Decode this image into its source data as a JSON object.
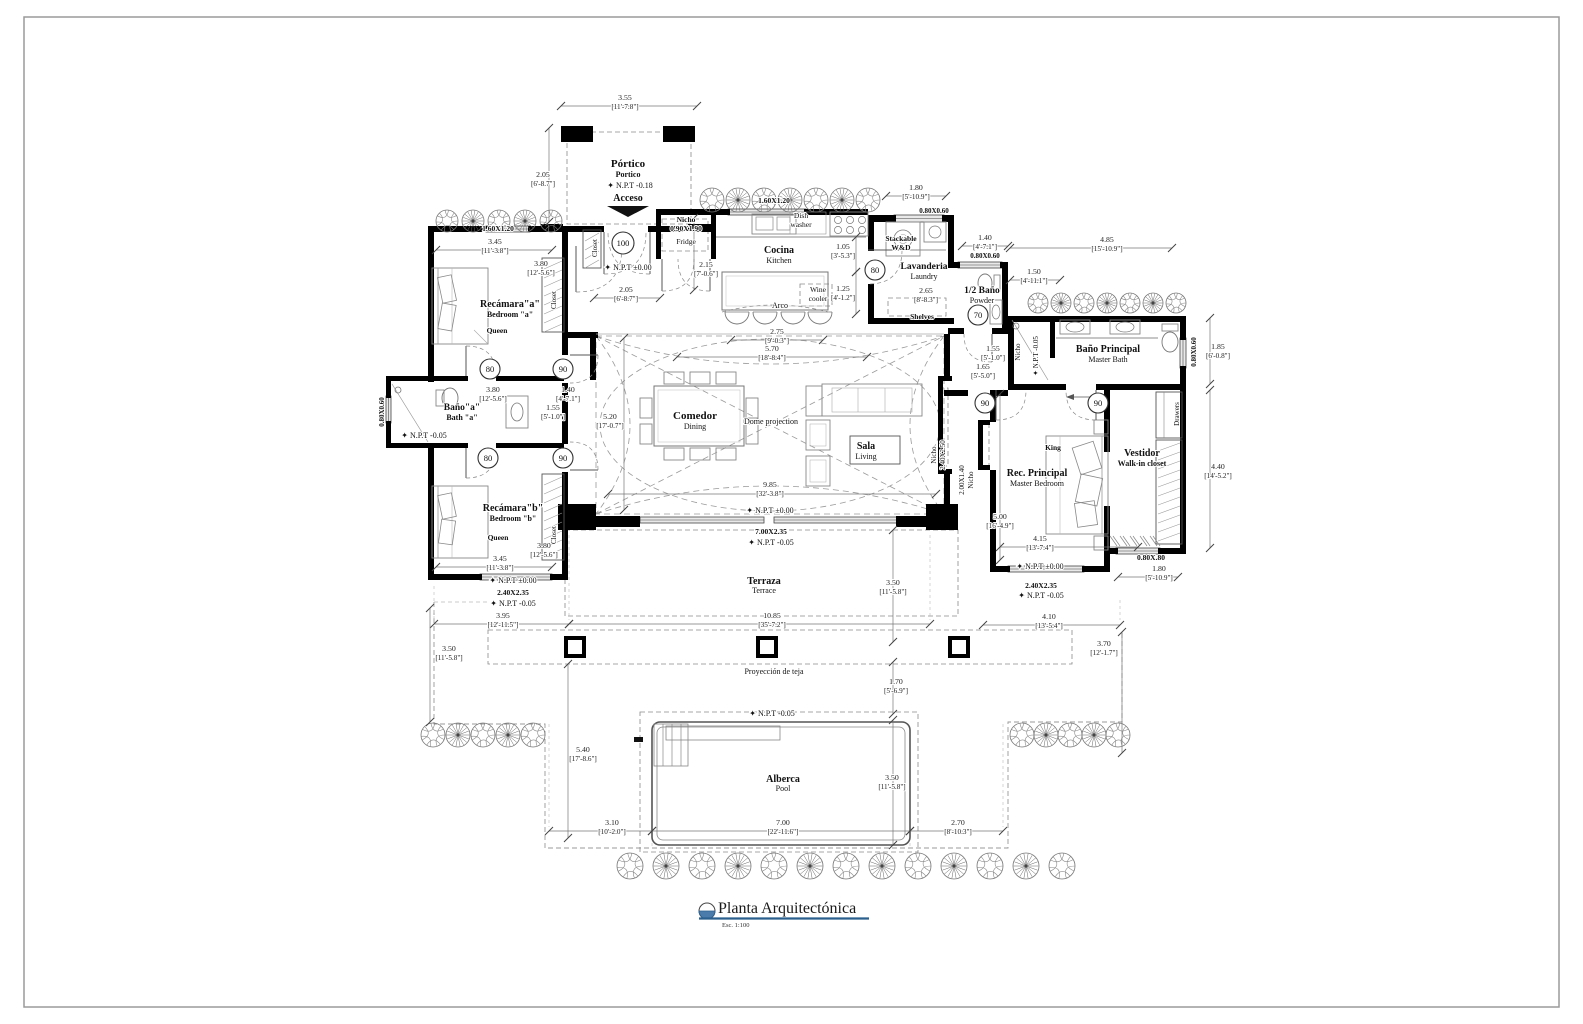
{
  "title_block": {
    "title": "Planta Arquitectónica",
    "scale": "Esc. 1:100"
  },
  "door_tags": [
    {
      "t": "100",
      "x": 623,
      "y": 243,
      "r": 11
    },
    {
      "t": "80",
      "x": 875,
      "y": 270,
      "r": 10
    },
    {
      "t": "70",
      "x": 978,
      "y": 315,
      "r": 10
    },
    {
      "t": "80",
      "x": 490,
      "y": 369,
      "r": 10
    },
    {
      "t": "90",
      "x": 563,
      "y": 369,
      "r": 10
    },
    {
      "t": "80",
      "x": 488,
      "y": 458,
      "r": 10
    },
    {
      "t": "90",
      "x": 563,
      "y": 458,
      "r": 10
    },
    {
      "t": "90",
      "x": 985,
      "y": 403,
      "r": 10
    },
    {
      "t": "90",
      "x": 1098,
      "y": 403,
      "r": 10
    }
  ],
  "labels": [
    {
      "t": "Pórtico",
      "x": 628,
      "y": 167,
      "s": 11,
      "b": 1,
      "n": "room-portico"
    },
    {
      "t": "Portico",
      "x": 628,
      "y": 177,
      "s": 8,
      "b": 1,
      "n": "room-portico-en"
    },
    {
      "t": "✦ N.P.T -0.18",
      "x": 630,
      "y": 188,
      "s": 8,
      "n": "npt-portico"
    },
    {
      "t": "Acceso",
      "x": 628,
      "y": 201,
      "s": 10,
      "b": 1,
      "n": "access-label"
    },
    {
      "t": "Closet",
      "x": 597,
      "y": 248,
      "s": 7,
      "r": -90,
      "n": "closet-foyer"
    },
    {
      "t": "✦ N.P.T ±0.00",
      "x": 628,
      "y": 270,
      "s": 8,
      "n": "npt-foyer"
    },
    {
      "t": "Nicho",
      "x": 686,
      "y": 222,
      "s": 7.5,
      "b": 1,
      "n": "fridge-nicho"
    },
    {
      "t": "0.90X1.90",
      "x": 686,
      "y": 231,
      "s": 7.5,
      "b": 1,
      "n": "fridge-nicho-size"
    },
    {
      "t": "Fridge",
      "x": 686,
      "y": 244,
      "s": 7.5,
      "n": "fridge"
    },
    {
      "t": "1.60X1.20",
      "x": 774,
      "y": 203,
      "s": 7.5,
      "b": 1,
      "n": "kitchen-window-size"
    },
    {
      "t": "Dish",
      "x": 801,
      "y": 218,
      "s": 7.5,
      "n": "dishwasher-1"
    },
    {
      "t": "washer",
      "x": 801,
      "y": 227,
      "s": 7.5,
      "n": "dishwasher-2"
    },
    {
      "t": "Cocina",
      "x": 779,
      "y": 253,
      "s": 10,
      "b": 1,
      "n": "room-kitchen"
    },
    {
      "t": "Kitchen",
      "x": 779,
      "y": 263,
      "s": 8,
      "n": "room-kitchen-en"
    },
    {
      "t": "Wine",
      "x": 818,
      "y": 292,
      "s": 7.5,
      "n": "wine-cooler-1"
    },
    {
      "t": "cooler",
      "x": 818,
      "y": 301,
      "s": 7.5,
      "n": "wine-cooler-2"
    },
    {
      "t": "Arco",
      "x": 780,
      "y": 308,
      "s": 8,
      "n": "arch-label"
    },
    {
      "t": "0.80X0.60",
      "x": 934,
      "y": 213,
      "s": 7,
      "b": 1,
      "n": "laundry-window-size"
    },
    {
      "t": "Stackable",
      "x": 901,
      "y": 241,
      "s": 7.5,
      "b": 1,
      "n": "washer-dryer-1"
    },
    {
      "t": "W&D",
      "x": 901,
      "y": 250,
      "s": 7.5,
      "b": 1,
      "n": "washer-dryer-2"
    },
    {
      "t": "Lavanderia",
      "x": 924,
      "y": 269,
      "s": 9.5,
      "b": 1,
      "n": "room-laundry"
    },
    {
      "t": "Laundry",
      "x": 924,
      "y": 279,
      "s": 8,
      "n": "room-laundry-en"
    },
    {
      "t": "Shelves",
      "x": 922,
      "y": 319,
      "s": 7.5,
      "b": 1,
      "n": "shelves"
    },
    {
      "t": "0.80X0.60",
      "x": 985,
      "y": 258,
      "s": 7,
      "b": 1,
      "n": "powder-window-size"
    },
    {
      "t": "1/2 Baño",
      "x": 982,
      "y": 293,
      "s": 9.5,
      "b": 1,
      "n": "room-powder"
    },
    {
      "t": "Powder",
      "x": 982,
      "y": 303,
      "s": 8,
      "n": "room-powder-en"
    },
    {
      "t": "Baño Principal",
      "x": 1108,
      "y": 352,
      "s": 10,
      "b": 1,
      "n": "room-master-bath"
    },
    {
      "t": "Master Bath",
      "x": 1108,
      "y": 362,
      "s": 8,
      "n": "room-master-bath-en"
    },
    {
      "t": "Nicho",
      "x": 1020,
      "y": 352,
      "s": 7,
      "r": -90,
      "n": "shower-nicho"
    },
    {
      "t": "✦ N.P.T -0.05",
      "x": 1038,
      "y": 356,
      "s": 7,
      "r": -90,
      "n": "npt-shower"
    },
    {
      "t": "0.80X0.60",
      "x": 1196,
      "y": 352,
      "s": 7,
      "b": 1,
      "r": -90,
      "n": "masterbath-window-size"
    },
    {
      "t": "1.60X1.20",
      "x": 498,
      "y": 231,
      "s": 7.5,
      "b": 1,
      "n": "bedroom-a-window-size"
    },
    {
      "t": "Recámara\"a\"",
      "x": 510,
      "y": 307,
      "s": 10,
      "b": 1,
      "n": "room-bedroom-a"
    },
    {
      "t": "Bedroom \"a\"",
      "x": 510,
      "y": 317,
      "s": 8,
      "b": 1,
      "n": "room-bedroom-a-en"
    },
    {
      "t": "Queen",
      "x": 497,
      "y": 333,
      "s": 7.5,
      "b": 1,
      "n": "bed-queen-a"
    },
    {
      "t": "Closet",
      "x": 556,
      "y": 300,
      "s": 7,
      "r": -90,
      "n": "closet-a"
    },
    {
      "t": "0.80X0.60",
      "x": 384,
      "y": 412,
      "s": 7,
      "b": 1,
      "r": -90,
      "n": "bath-a-window-size"
    },
    {
      "t": "Baño\"a\"",
      "x": 462,
      "y": 410,
      "s": 9.5,
      "b": 1,
      "n": "room-bath-a"
    },
    {
      "t": "Bath \"a\"",
      "x": 462,
      "y": 420,
      "s": 8,
      "b": 1,
      "n": "room-bath-a-en"
    },
    {
      "t": "✦ N.P.T -0.05",
      "x": 424,
      "y": 438,
      "s": 8,
      "n": "npt-bath-a"
    },
    {
      "t": "Recámara\"b\"",
      "x": 513,
      "y": 511,
      "s": 10,
      "b": 1,
      "n": "room-bedroom-b"
    },
    {
      "t": "Bedroom \"b\"",
      "x": 513,
      "y": 521,
      "s": 8,
      "b": 1,
      "n": "room-bedroom-b-en"
    },
    {
      "t": "Queen",
      "x": 498,
      "y": 540,
      "s": 7.5,
      "b": 1,
      "n": "bed-queen-b"
    },
    {
      "t": "Closet",
      "x": 556,
      "y": 535,
      "s": 7,
      "r": -90,
      "n": "closet-b"
    },
    {
      "t": "✦ N.P.T ±0.00",
      "x": 513,
      "y": 583,
      "s": 8,
      "n": "npt-bedroom-b"
    },
    {
      "t": "2.40X2.35",
      "x": 513,
      "y": 595,
      "s": 7.5,
      "b": 1,
      "n": "bedroom-b-window-size"
    },
    {
      "t": "✦ N.P.T -0.05",
      "x": 513,
      "y": 606,
      "s": 8,
      "n": "npt-bedroom-b-out"
    },
    {
      "t": "Comedor",
      "x": 695,
      "y": 419,
      "s": 11,
      "b": 1,
      "n": "room-dining"
    },
    {
      "t": "Dining",
      "x": 695,
      "y": 429,
      "s": 8,
      "n": "room-dining-en"
    },
    {
      "t": "Dome projection",
      "x": 771,
      "y": 424,
      "s": 8,
      "n": "dome-projection"
    },
    {
      "t": "Sala",
      "x": 866,
      "y": 449,
      "s": 10,
      "b": 1,
      "n": "room-living"
    },
    {
      "t": "Living",
      "x": 866,
      "y": 459,
      "s": 8,
      "n": "room-living-en"
    },
    {
      "t": "✦ N.P.T ±0.00",
      "x": 770,
      "y": 513,
      "s": 8,
      "n": "npt-greatroom"
    },
    {
      "t": "7.00X2.35",
      "x": 771,
      "y": 534,
      "s": 7.5,
      "b": 1,
      "n": "terrace-door-size"
    },
    {
      "t": "✦ N.P.T -0.05",
      "x": 771,
      "y": 545,
      "s": 8,
      "n": "npt-terrace-door"
    },
    {
      "t": "Nicho",
      "x": 936,
      "y": 455,
      "s": 7,
      "r": -90,
      "n": "wall-nicho-1"
    },
    {
      "t": "2.40X2.50",
      "x": 945,
      "y": 455,
      "s": 7,
      "r": -90,
      "n": "wall-nicho-1-size"
    },
    {
      "t": "2.00X1.40",
      "x": 964,
      "y": 480,
      "s": 7,
      "r": -90,
      "n": "wall-nicho-2-size"
    },
    {
      "t": "Nicho",
      "x": 973,
      "y": 480,
      "s": 7,
      "r": -90,
      "n": "wall-nicho-2"
    },
    {
      "t": "Rec. Principal",
      "x": 1037,
      "y": 476,
      "s": 10,
      "b": 1,
      "n": "room-master-bedroom"
    },
    {
      "t": "Master Bedroom",
      "x": 1037,
      "y": 486,
      "s": 8,
      "n": "room-master-bedroom-en"
    },
    {
      "t": "King",
      "x": 1053,
      "y": 450,
      "s": 7.5,
      "b": 1,
      "n": "bed-king"
    },
    {
      "t": "✦ N.P.T ±0.00",
      "x": 1040,
      "y": 569,
      "s": 8,
      "n": "npt-master"
    },
    {
      "t": "2.40X2.35",
      "x": 1041,
      "y": 588,
      "s": 7.5,
      "b": 1,
      "n": "master-window-size"
    },
    {
      "t": "✦ N.P.T -0.05",
      "x": 1041,
      "y": 598,
      "s": 8,
      "n": "npt-master-out"
    },
    {
      "t": "Vestidor",
      "x": 1142,
      "y": 456,
      "s": 10,
      "b": 1,
      "n": "room-closet"
    },
    {
      "t": "Walk-in closet",
      "x": 1142,
      "y": 466,
      "s": 8,
      "b": 1,
      "n": "room-closet-en"
    },
    {
      "t": "Drawers",
      "x": 1179,
      "y": 414,
      "s": 7,
      "r": -90,
      "n": "drawers"
    },
    {
      "t": "0.80X.80",
      "x": 1151,
      "y": 560,
      "s": 7.5,
      "b": 1,
      "n": "vestidor-window-size"
    },
    {
      "t": "Terraza",
      "x": 764,
      "y": 584,
      "s": 10,
      "b": 1,
      "n": "room-terrace"
    },
    {
      "t": "Terrace",
      "x": 764,
      "y": 593,
      "s": 8,
      "n": "room-terrace-en"
    },
    {
      "t": "Proyección de teja",
      "x": 774,
      "y": 674,
      "s": 8,
      "n": "roof-projection"
    },
    {
      "t": "✦ N.P.T -0.05",
      "x": 772,
      "y": 716,
      "s": 8,
      "n": "npt-pool-deck"
    },
    {
      "t": "Alberca",
      "x": 783,
      "y": 782,
      "s": 10,
      "b": 1,
      "n": "room-pool"
    },
    {
      "t": "Pool",
      "x": 783,
      "y": 791,
      "s": 8,
      "n": "room-pool-en"
    }
  ],
  "dims": [
    {
      "m": "3.55",
      "i": "[11'-7.8\"]",
      "x": 625,
      "y": 100,
      "line": [
        561,
        106,
        697,
        106
      ]
    },
    {
      "m": "2.05",
      "i": "[6'-8.7\"]",
      "x": 543,
      "y": 177,
      "line": [
        549,
        128,
        549,
        222
      ]
    },
    {
      "m": "3.45",
      "i": "[11'-3.8\"]",
      "x": 495,
      "y": 244,
      "line": [
        436,
        250,
        552,
        250
      ]
    },
    {
      "m": "3.80",
      "i": "[12'-5.6\"]",
      "x": 541,
      "y": 266,
      "line": null
    },
    {
      "m": "2.05",
      "i": "[6'-8.7\"]",
      "x": 626,
      "y": 292,
      "line": [
        594,
        298,
        660,
        298
      ]
    },
    {
      "m": "2.15",
      "i": "[7'-0.6\"]",
      "x": 706,
      "y": 267,
      "line": [
        694,
        218,
        694,
        290
      ]
    },
    {
      "m": "1.05",
      "i": "[3'-5.3\"]",
      "x": 843,
      "y": 249,
      "line": [
        856,
        237,
        856,
        272
      ]
    },
    {
      "m": "1.25",
      "i": "[4'-1.2\"]",
      "x": 843,
      "y": 291,
      "line": [
        856,
        272,
        856,
        314
      ]
    },
    {
      "m": "2.75",
      "i": "[9'-0.3\"]",
      "x": 777,
      "y": 334,
      "line": [
        731,
        340,
        823,
        340
      ]
    },
    {
      "m": "5.70",
      "i": "[18'-8.4\"]",
      "x": 772,
      "y": 351,
      "line": [
        677,
        357,
        867,
        357
      ]
    },
    {
      "m": "1.80",
      "i": "[5'-10.9\"]",
      "x": 916,
      "y": 190,
      "line": [
        886,
        196,
        946,
        196
      ]
    },
    {
      "m": "1.40",
      "i": "[4'-7.1\"]",
      "x": 985,
      "y": 240,
      "line": [
        962,
        246,
        1008,
        246
      ]
    },
    {
      "m": "1.50",
      "i": "[4'-11.1\"]",
      "x": 1034,
      "y": 274,
      "line": [
        1010,
        280,
        1060,
        280
      ]
    },
    {
      "m": "2.65",
      "i": "[8'-8.3\"]",
      "x": 926,
      "y": 293,
      "line": null
    },
    {
      "m": "4.85",
      "i": "[15'-10.9\"]",
      "x": 1107,
      "y": 242,
      "line": [
        1010,
        248,
        1172,
        248
      ]
    },
    {
      "m": "1.55",
      "i": "[5'-1.0\"]",
      "x": 993,
      "y": 351,
      "line": null
    },
    {
      "m": "1.65",
      "i": "[5'-5.0\"]",
      "x": 983,
      "y": 369,
      "line": null
    },
    {
      "m": "1.85",
      "i": "[6'-0.8\"]",
      "x": 1218,
      "y": 349,
      "line": [
        1210,
        318,
        1210,
        384
      ]
    },
    {
      "m": "4.40",
      "i": "[14'-5.2\"]",
      "x": 1218,
      "y": 469,
      "line": [
        1210,
        390,
        1210,
        548
      ]
    },
    {
      "m": "3.45",
      "i": "[11'-3.8\"]",
      "x": 500,
      "y": 561,
      "line": [
        436,
        567,
        552,
        567
      ]
    },
    {
      "m": "3.80",
      "i": "[12'-5.6\"]",
      "x": 544,
      "y": 548,
      "line": null
    },
    {
      "m": "3.80",
      "i": "[12'-5.6\"]",
      "x": 493,
      "y": 392,
      "line": null
    },
    {
      "m": "1.40",
      "i": "[4'-7.1\"]",
      "x": 568,
      "y": 392,
      "line": null
    },
    {
      "m": "1.55",
      "i": "[5'-1.0\"]",
      "x": 553,
      "y": 410,
      "line": null
    },
    {
      "m": "5.20",
      "i": "[17'-0.7\"]",
      "x": 610,
      "y": 419,
      "line": [
        624,
        338,
        624,
        510
      ]
    },
    {
      "m": "9.85",
      "i": "[32'-3.8\"]",
      "x": 770,
      "y": 487,
      "line": [
        608,
        494,
        936,
        494
      ]
    },
    {
      "m": "5.00",
      "i": "[16'-4.9\"]",
      "x": 1000,
      "y": 519,
      "line": [
        1000,
        394,
        1000,
        560
      ]
    },
    {
      "m": "4.15",
      "i": "[13'-7.4\"]",
      "x": 1040,
      "y": 541,
      "line": [
        1000,
        547,
        1138,
        547
      ]
    },
    {
      "m": "3.95",
      "i": "[12'-11.5\"]",
      "x": 503,
      "y": 618,
      "line": [
        434,
        624,
        569,
        624
      ]
    },
    {
      "m": "10.85",
      "i": "[35'-7.2\"]",
      "x": 772,
      "y": 618,
      "line": [
        569,
        624,
        930,
        624
      ]
    },
    {
      "m": "4.10",
      "i": "[13'-5.4\"]",
      "x": 1049,
      "y": 619,
      "line": [
        983,
        625,
        1120,
        625
      ]
    },
    {
      "m": "3.50",
      "i": "[11'-5.8\"]",
      "x": 449,
      "y": 651,
      "line": [
        430,
        608,
        430,
        722
      ]
    },
    {
      "m": "3.70",
      "i": "[12'-1.7\"]",
      "x": 1104,
      "y": 646,
      "line": [
        1122,
        632,
        1122,
        753
      ]
    },
    {
      "m": "5.40",
      "i": "[17'-8.6\"]",
      "x": 583,
      "y": 752,
      "line": [
        568,
        664,
        568,
        838
      ]
    },
    {
      "m": "1.70",
      "i": "[5'-6.9\"]",
      "x": 896,
      "y": 684,
      "line": [
        893,
        662,
        893,
        714
      ]
    },
    {
      "m": "3.50",
      "i": "[11'-5.8\"]",
      "x": 893,
      "y": 585,
      "line": [
        893,
        530,
        893,
        642
      ]
    },
    {
      "m": "3.50",
      "i": "[11'-5.8\"]",
      "x": 892,
      "y": 780,
      "line": [
        893,
        720,
        893,
        845
      ]
    },
    {
      "m": "3.10",
      "i": "[10'-2.0\"]",
      "x": 612,
      "y": 825,
      "line": [
        549,
        831,
        652,
        831
      ]
    },
    {
      "m": "7.00",
      "i": "[22'-11.6\"]",
      "x": 783,
      "y": 825,
      "line": [
        652,
        831,
        910,
        831
      ]
    },
    {
      "m": "2.70",
      "i": "[8'-10.3\"]",
      "x": 958,
      "y": 825,
      "line": [
        910,
        831,
        1003,
        831
      ]
    },
    {
      "m": "1.80",
      "i": "[5'-10.9\"]",
      "x": 1159,
      "y": 571,
      "line": [
        1118,
        577,
        1178,
        577
      ]
    }
  ]
}
